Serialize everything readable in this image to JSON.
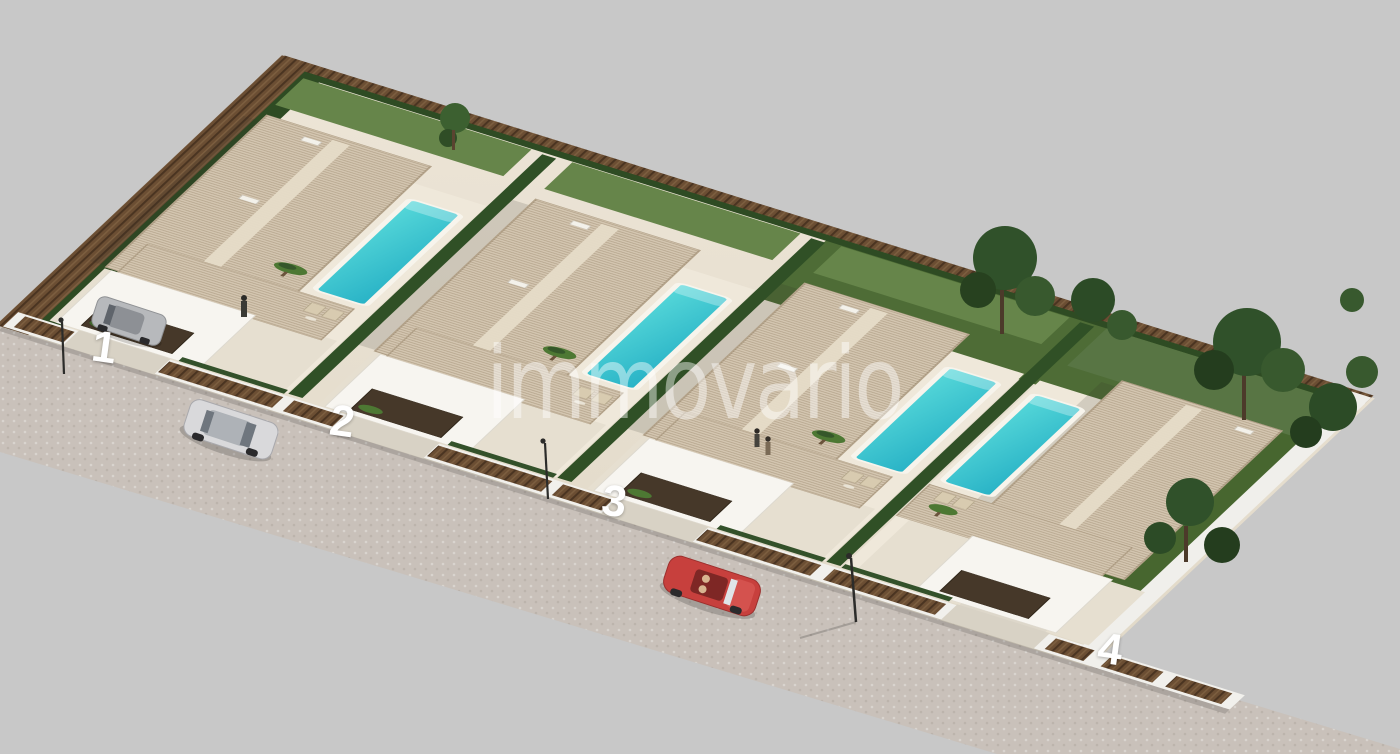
{
  "scene": {
    "watermark": "immovario",
    "villas": [
      {
        "label": "1"
      },
      {
        "label": "2"
      },
      {
        "label": "3"
      },
      {
        "label": "4"
      }
    ],
    "colors": {
      "background": "#c8c8c8",
      "road": "#c9c1ba",
      "plot_ground": "#e8e0d1",
      "terrace": "#efe8da",
      "roof_tile": "#cfc0a9",
      "roof_ridge": "#e6dcc8",
      "pool_turquoise": "#35c2cd",
      "hedge_green": "#2f4d24",
      "grass_green": "#4e6c36",
      "fence_brown": "#6b4e33",
      "wall_white": "#f1f0ec",
      "garage_door": "#463829",
      "tree_green": "#30512a",
      "car_silver": "#d9d9db",
      "car_red": "#c7403d",
      "car_grey": "#b7b9bc",
      "label_white": "#ffffff"
    }
  }
}
